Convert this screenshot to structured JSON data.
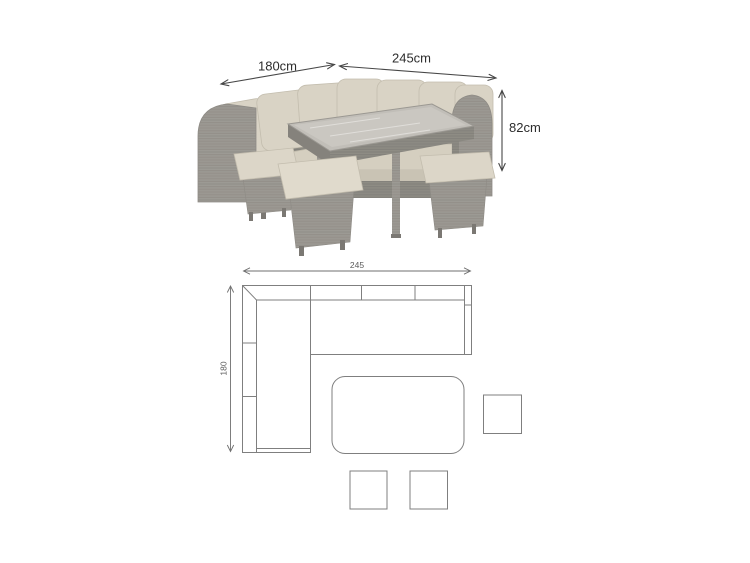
{
  "photo": {
    "width_label": "180cm",
    "length_label": "245cm",
    "height_label": "82cm",
    "icons": {
      "width_arrow": "double-headed-diagonal-arrow",
      "length_arrow": "double-headed-diagonal-arrow",
      "height_arrow": "double-headed-vertical-arrow"
    },
    "subject": "grey rattan corner sofa dining set with glass-top table and three footstools"
  },
  "schematic": {
    "length_label": "245",
    "depth_label": "180",
    "icons": {
      "length_dimension": "double-headed-horizontal-arrow",
      "depth_dimension": "double-headed-vertical-arrow"
    }
  },
  "colors": {
    "background": "#ffffff",
    "rattan_grey": "#a3a09a",
    "rattan_dark": "#949189",
    "cushion_beige": "#d9d3c5",
    "glass_grey": "#c1beb8",
    "photo_dimension_text": "#2d2d2d",
    "drawing_line": "#7f7f7f",
    "drawing_text": "#5a5a5a"
  }
}
